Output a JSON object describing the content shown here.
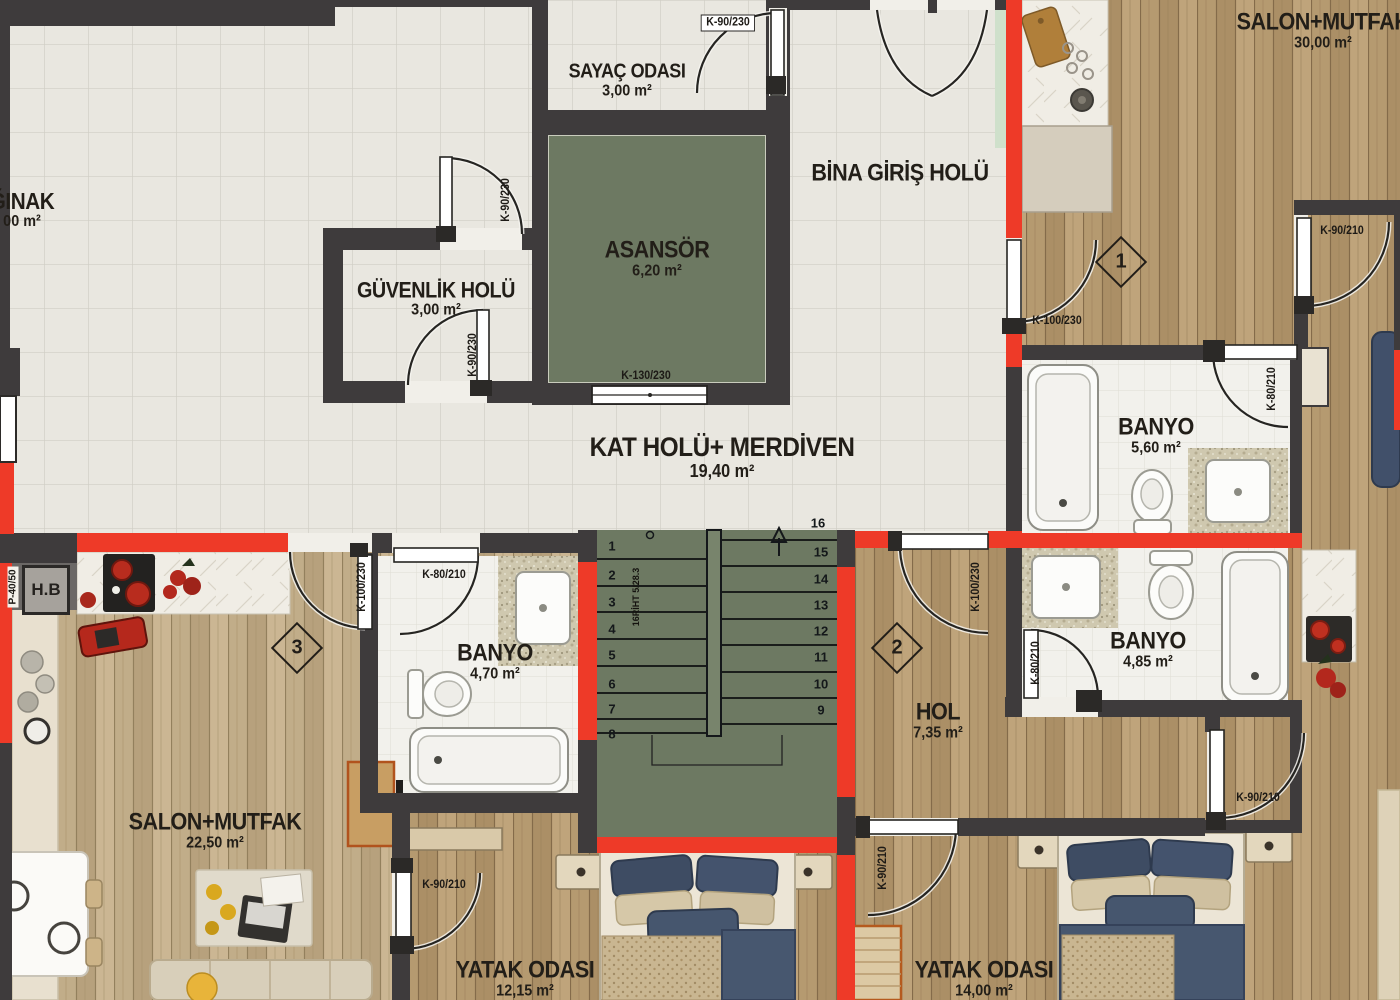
{
  "palette": {
    "wall": "#3e3b3c",
    "red_wall": "#ee3a28",
    "stair_green": "#6d7962",
    "tile": "#e9e7e0",
    "wood": "#b79c73",
    "bath_tile": "#f2f1ec",
    "text": "#221e18"
  },
  "rooms": [
    {
      "id": "siginak",
      "name": "ĞINAK",
      "area": "00 m²"
    },
    {
      "id": "sayac_odasi",
      "name": "SAYAÇ ODASI",
      "area": "3,00 m²"
    },
    {
      "id": "bina_giris_holu",
      "name": "BİNA GİRİŞ HOLÜ",
      "area": ""
    },
    {
      "id": "asansor",
      "name": "ASANSÖR",
      "area": "6,20 m²"
    },
    {
      "id": "guvenlik_holu",
      "name": "GÜVENLİK HOLÜ",
      "area": "3,00 m²"
    },
    {
      "id": "kat_holu_merdiven",
      "name": "KAT HOLÜ+ MERDİVEN",
      "area": "19,40 m²"
    },
    {
      "id": "banyo_ust",
      "name": "BANYO",
      "area": "5,60 m²"
    },
    {
      "id": "banyo_orta",
      "name": "BANYO",
      "area": "4,85 m²"
    },
    {
      "id": "banyo_sol",
      "name": "BANYO",
      "area": "4,70 m²"
    },
    {
      "id": "hol",
      "name": "HOL",
      "area": "7,35 m²"
    },
    {
      "id": "salon_mutfak_sag",
      "name": "SALON+MUTFAK",
      "area": "30,00 m²"
    },
    {
      "id": "salon_mutfak_sol",
      "name": "SALON+MUTFAK",
      "area": "22,50 m²"
    },
    {
      "id": "yatak_odasi_orta",
      "name": "YATAK ODASI",
      "area": "12,15 m²"
    },
    {
      "id": "yatak_odasi_sag",
      "name": "YATAK ODASI",
      "area": "14,00 m²"
    }
  ],
  "doors": [
    {
      "label": "K-90/230"
    },
    {
      "label": "K-90/230"
    },
    {
      "label": "K-90/230"
    },
    {
      "label": "K-130/230"
    },
    {
      "label": "K-100/230"
    },
    {
      "label": "K-90/210"
    },
    {
      "label": "K-80/210"
    },
    {
      "label": "K-100/230"
    },
    {
      "label": "K-80/210"
    },
    {
      "label": "K-90/210"
    },
    {
      "label": "K-90/210"
    },
    {
      "label": "K-90/210"
    },
    {
      "label": "K-100/230"
    },
    {
      "label": "K-80/210"
    }
  ],
  "units": [
    "1",
    "2",
    "3"
  ],
  "stairs": {
    "steps": [
      "1",
      "2",
      "3",
      "4",
      "5",
      "6",
      "7",
      "8",
      "9",
      "10",
      "11",
      "12",
      "13",
      "14",
      "15",
      "16"
    ],
    "note": "16RİHT 5/28.3"
  },
  "annotations": {
    "hb": "H.B",
    "p_label": "P-40/50"
  }
}
